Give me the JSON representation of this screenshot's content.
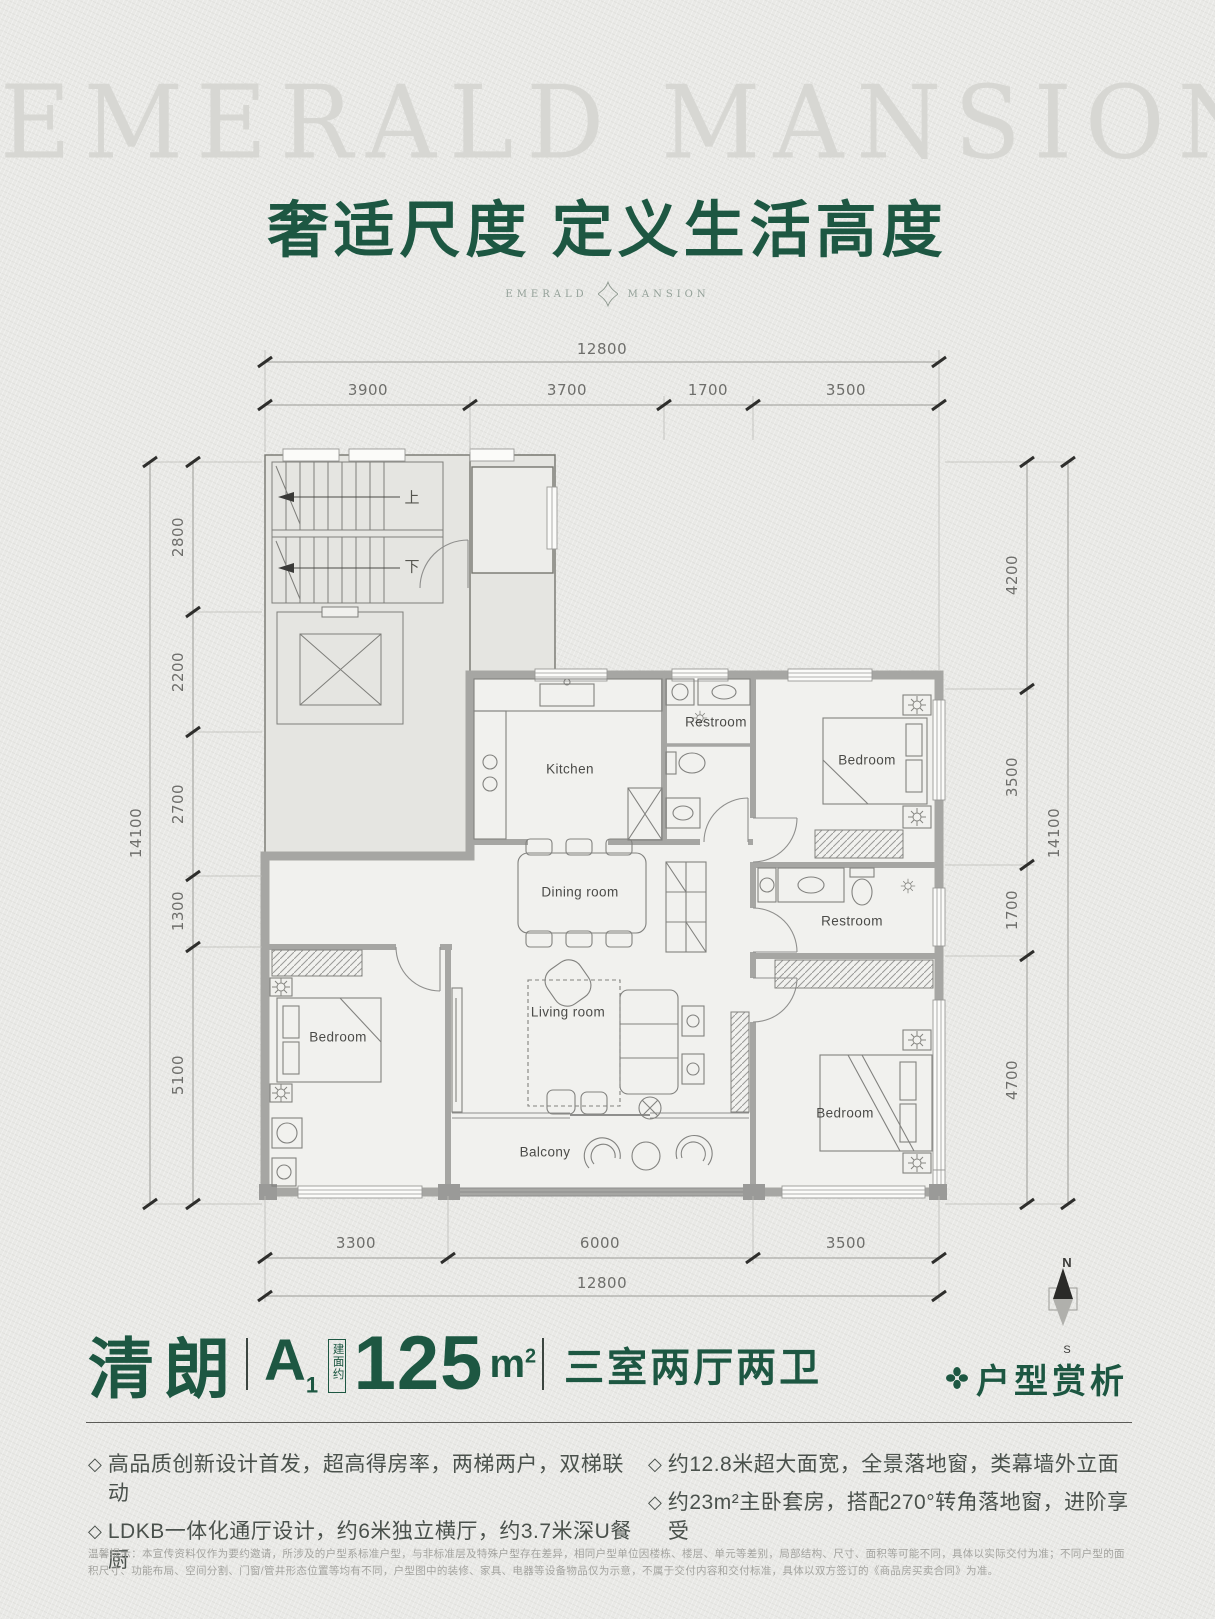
{
  "brand": {
    "watermark": "EMERALD MANSION",
    "title": "奢适尺度 定义生活高度",
    "logo_left": "EMERALD",
    "logo_right": "MANSION"
  },
  "plan": {
    "stairs": {
      "up": "上",
      "down": "下"
    },
    "rooms": {
      "kitchen": "Kitchen",
      "restroom_top": "Restroom",
      "bedroom_top_right": "Bedroom",
      "dining": "Dining room",
      "living": "Living room",
      "restroom_middle": "Restroom",
      "bedroom_left": "Bedroom",
      "bedroom_bottom_right": "Bedroom",
      "balcony": "Balcony"
    },
    "dims": {
      "top": {
        "total": "12800",
        "segments": [
          "3900",
          "3700",
          "1700",
          "3500"
        ]
      },
      "bottom": {
        "total": "12800",
        "segments": [
          "3300",
          "6000",
          "3500"
        ]
      },
      "left": {
        "total": "14100",
        "segments": [
          "2800",
          "2200",
          "2700",
          "1300",
          "5100"
        ]
      },
      "right": {
        "total": "14100",
        "segments": [
          "4200",
          "3500",
          "1700",
          "4700"
        ]
      }
    },
    "compass": {
      "north": "N",
      "south": "S"
    }
  },
  "info": {
    "name": "清朗",
    "unit_letter": "A",
    "unit_number": "1",
    "area_prefix": "建面约",
    "area_value": "125",
    "area_unit": "m",
    "area_exponent": "2",
    "layout": "三室两厅两卫",
    "section_title": "户型赏析"
  },
  "features": {
    "bullet": "◇",
    "left": [
      "高品质创新设计首发，超高得房率，两梯两户，双梯联动",
      "LDKB一体化通厅设计，约6米独立横厅，约3.7米深U餐厨"
    ],
    "right": [
      "约12.8米超大面宽，全景落地窗，类幕墙外立面",
      "约23m²主卧套房，搭配270°转角落地窗，进阶享受"
    ]
  },
  "disclaimer": "温馨提示：本宣传资料仅作为要约邀请，所涉及的户型系标准户型，与非标准层及特殊户型存在差异，相同户型单位因楼栋、楼层、单元等差别，局部结构、尺寸、面积等可能不同，具体以实际交付为准；不同户型的面积尺寸、功能布局、空间分割、门窗/管井形态位置等均有不同，户型图中的装修、家具、电器等设备物品仅为示意，不属于交付内容和交付标准，具体以双方签订的《商品房买卖合同》为准。",
  "colors": {
    "brand_green": "#1d5742",
    "wall_gray": "#a6a6a3"
  }
}
